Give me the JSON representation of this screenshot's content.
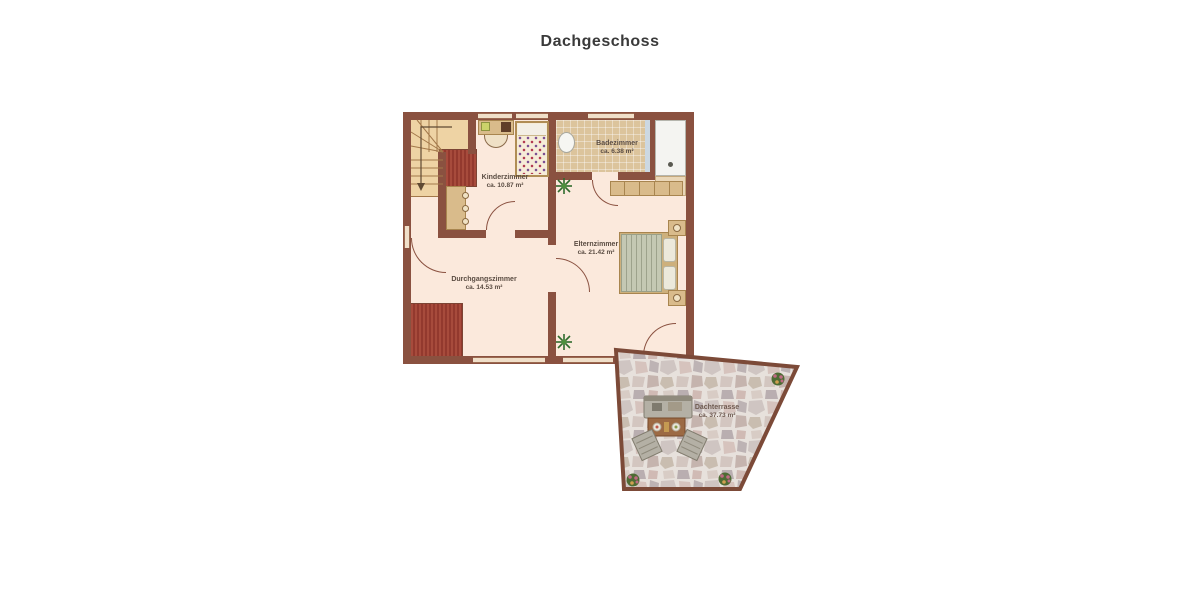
{
  "title": "Dachgeschoss",
  "rooms": {
    "kinderzimmer": {
      "name": "Kinderzimmer",
      "area": "ca. 10.87 m²"
    },
    "badezimmer": {
      "name": "Badezimmer",
      "area": "ca. 6.38 m²"
    },
    "elternzimmer": {
      "name": "Elternzimmer",
      "area": "ca. 21.42 m²"
    },
    "durchgangszimmer": {
      "name": "Durchgangszimmer",
      "area": "ca. 14.53 m²"
    },
    "dachterrasse": {
      "name": "Dachterrasse",
      "area": "ca. 37.73 m²"
    }
  },
  "colors": {
    "wall": "#8a5140",
    "floor": "#fbe9dc",
    "hatch": "#9c4038",
    "wood": "#eed3a4",
    "tile": "#dcc49c",
    "blue_tile": "#ccd8e2",
    "tub": "#f4f4f1",
    "furniture": "#d9bb8b",
    "duvet": "#c4c8b3",
    "plant": "#2f6b2c",
    "title_text": "#3a3a3a",
    "label_text": "#5a4c42"
  }
}
